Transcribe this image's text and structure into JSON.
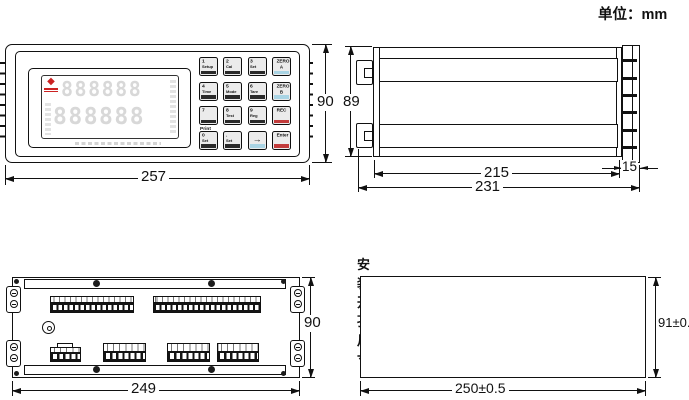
{
  "unit_label": "单位：mm",
  "front": {
    "dim_width": "257",
    "dim_height": "90",
    "display_digits_row1": "888888",
    "display_digits_row2": "888888",
    "print_label": "Print",
    "keys": [
      {
        "num": "1",
        "label": "Setup",
        "bar": "dark"
      },
      {
        "num": "2",
        "label": "Cal",
        "bar": "dark"
      },
      {
        "num": "3",
        "label": "Set",
        "bar": "dark"
      },
      {
        "num": "ZERO",
        "label": "A",
        "bar": "blue"
      },
      {
        "num": "4",
        "label": "Time",
        "bar": "dark"
      },
      {
        "num": "5",
        "label": "Mode",
        "bar": "dark"
      },
      {
        "num": "6",
        "label": "Tare",
        "bar": "dark"
      },
      {
        "num": "ZERO",
        "label": "B",
        "bar": "blue"
      },
      {
        "num": "7",
        "label": "",
        "bar": "dark"
      },
      {
        "num": "8",
        "label": "Test",
        "bar": "dark"
      },
      {
        "num": "9",
        "label": "Reg",
        "bar": "dark"
      },
      {
        "num": "REC",
        "label": "",
        "bar": "red"
      },
      {
        "num": "0",
        "label": "Set",
        "bar": "dark"
      },
      {
        "num": ".",
        "label": "Set",
        "bar": "dark"
      },
      {
        "num": "→",
        "label": "",
        "bar": "blue"
      },
      {
        "num": "Enter",
        "label": "",
        "bar": "red"
      }
    ]
  },
  "side": {
    "dim_height": "89",
    "dim_body_depth": "215",
    "dim_total_depth": "231",
    "dim_bezel_depth": "15"
  },
  "rear": {
    "dim_width": "249",
    "dim_height": "90"
  },
  "cutout": {
    "title": "安装开孔尺寸",
    "dim_width": "250±0.5",
    "dim_height": "91±0.5"
  },
  "colors": {
    "line_black": "#111111",
    "key_accent_blue": "#a9d4e4",
    "key_accent_red": "#c23b3b",
    "logo_red": "#cc2222",
    "digit_gray": "#d8d8d8"
  }
}
